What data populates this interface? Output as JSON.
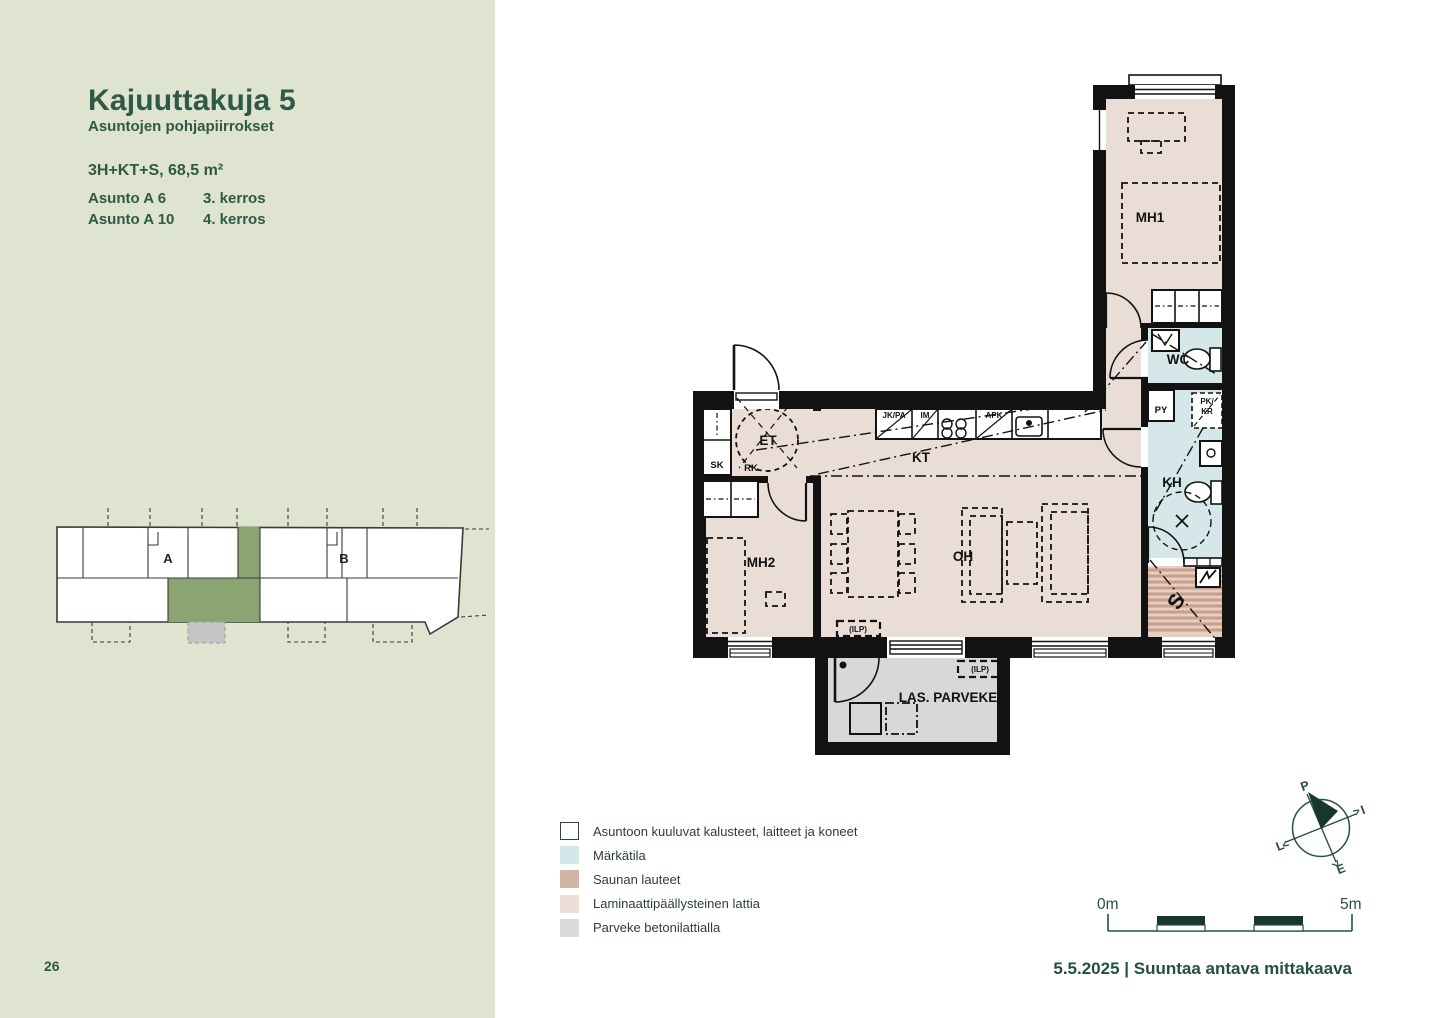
{
  "sidebar": {
    "title": "Kajuuttakuja 5",
    "subtitle": "Asuntojen pohjapiirrokset",
    "apartment_type": "3H+KT+S, 68,5 m²",
    "units": [
      {
        "name": "Asunto A 6",
        "floor": "3. kerros"
      },
      {
        "name": "Asunto A 10",
        "floor": "4. kerros"
      }
    ],
    "page_number": "26",
    "key_plan": {
      "stairwell_a": "A",
      "stairwell_b": "B"
    }
  },
  "floor_plan": {
    "rooms": {
      "mh1": "MH1",
      "mh2": "MH2",
      "kt": "KT",
      "oh": "OH",
      "et": "ET",
      "kh": "KH",
      "wc": "WC",
      "sauna": "S",
      "balcony": "LAS. PARVEKE"
    },
    "fixtures": {
      "sk": "SK",
      "rk": "RK",
      "py": "PY",
      "pk": "PK/",
      "kr": "KR",
      "jk_pa": "JK/PA",
      "im": "IM",
      "apk": "APK",
      "ilp_living": "(ILP)",
      "ilp_balcony": "(ILP)"
    }
  },
  "legend": {
    "items": [
      {
        "label": "Asuntoon kuuluvat kalusteet, laitteet ja koneet",
        "swatch": "#ffffff"
      },
      {
        "label": "Märkätila",
        "swatch": "#d3e6e9"
      },
      {
        "label": "Saunan lauteet",
        "swatch": "#d1b5a4"
      },
      {
        "label": "Laminaattipäällysteinen lattia",
        "swatch": "#ecdfd8"
      },
      {
        "label": "Parveke betonilattialla",
        "swatch": "#d8dbd8"
      }
    ]
  },
  "compass": {
    "north": "P",
    "east": "I",
    "west": "L",
    "south": "E"
  },
  "scale_bar": {
    "start": "0m",
    "end": "5m"
  },
  "footer": {
    "text": "5.5.2025 | Suuntaa antava mittakaava"
  },
  "colors": {
    "accent_green": "#2d5945",
    "sidebar_bg": "#dfe4d1",
    "laminate_floor": "#eaddd6",
    "wet_room": "#d5e7e8",
    "sauna_base": "#e8cec0",
    "sauna_stripe": "#c79f8c",
    "balcony_floor": "#d8d8d8",
    "wall": "#121212",
    "key_plan_highlight": "#8ca472",
    "key_plan_balcony": "#c4c4c4"
  }
}
